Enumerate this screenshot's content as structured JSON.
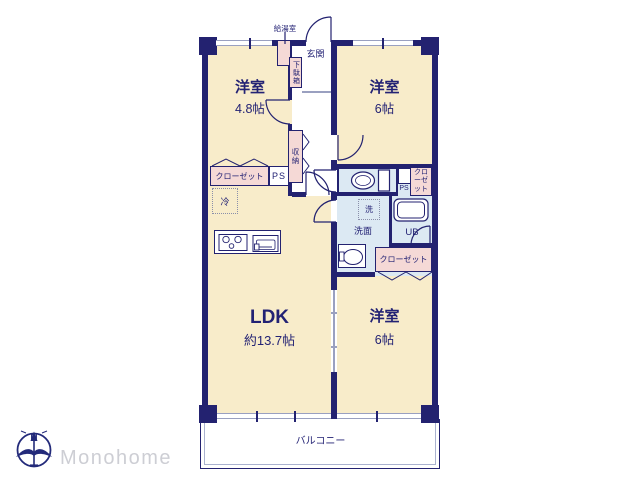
{
  "colors": {
    "wall": "#232270",
    "room_fill": "#f8ecca",
    "closet_fill": "#f5d9d6",
    "wet_area_fill": "#dce9f3",
    "window_line": "#9aa0c0",
    "brand_text": "#cdced4"
  },
  "rooms": {
    "bedroom_top_left": {
      "name": "洋室",
      "size": "4.8帖"
    },
    "bedroom_top_right": {
      "name": "洋室",
      "size": "6帖"
    },
    "ldk": {
      "name": "LDK",
      "size": "約13.7帖"
    },
    "bedroom_bottom_right": {
      "name": "洋室",
      "size": "6帖"
    },
    "entrance": {
      "name": "玄関"
    },
    "balcony": {
      "name": "バルコニー"
    }
  },
  "fixtures": {
    "water_heater": "給湯室",
    "shoe_cabinet": "下駄箱",
    "storage": "収納",
    "closet_left": "クローゼット",
    "ps_left": "PS",
    "refrigerator": "冷",
    "ps_right": "PS",
    "closet_right_top": "クローゼット",
    "washer": "洗",
    "washroom": "洗面",
    "unit_bath": "UB",
    "closet_right_bottom": "クローゼット"
  },
  "branding": {
    "company": "Monohome",
    "compass_north": "N"
  }
}
